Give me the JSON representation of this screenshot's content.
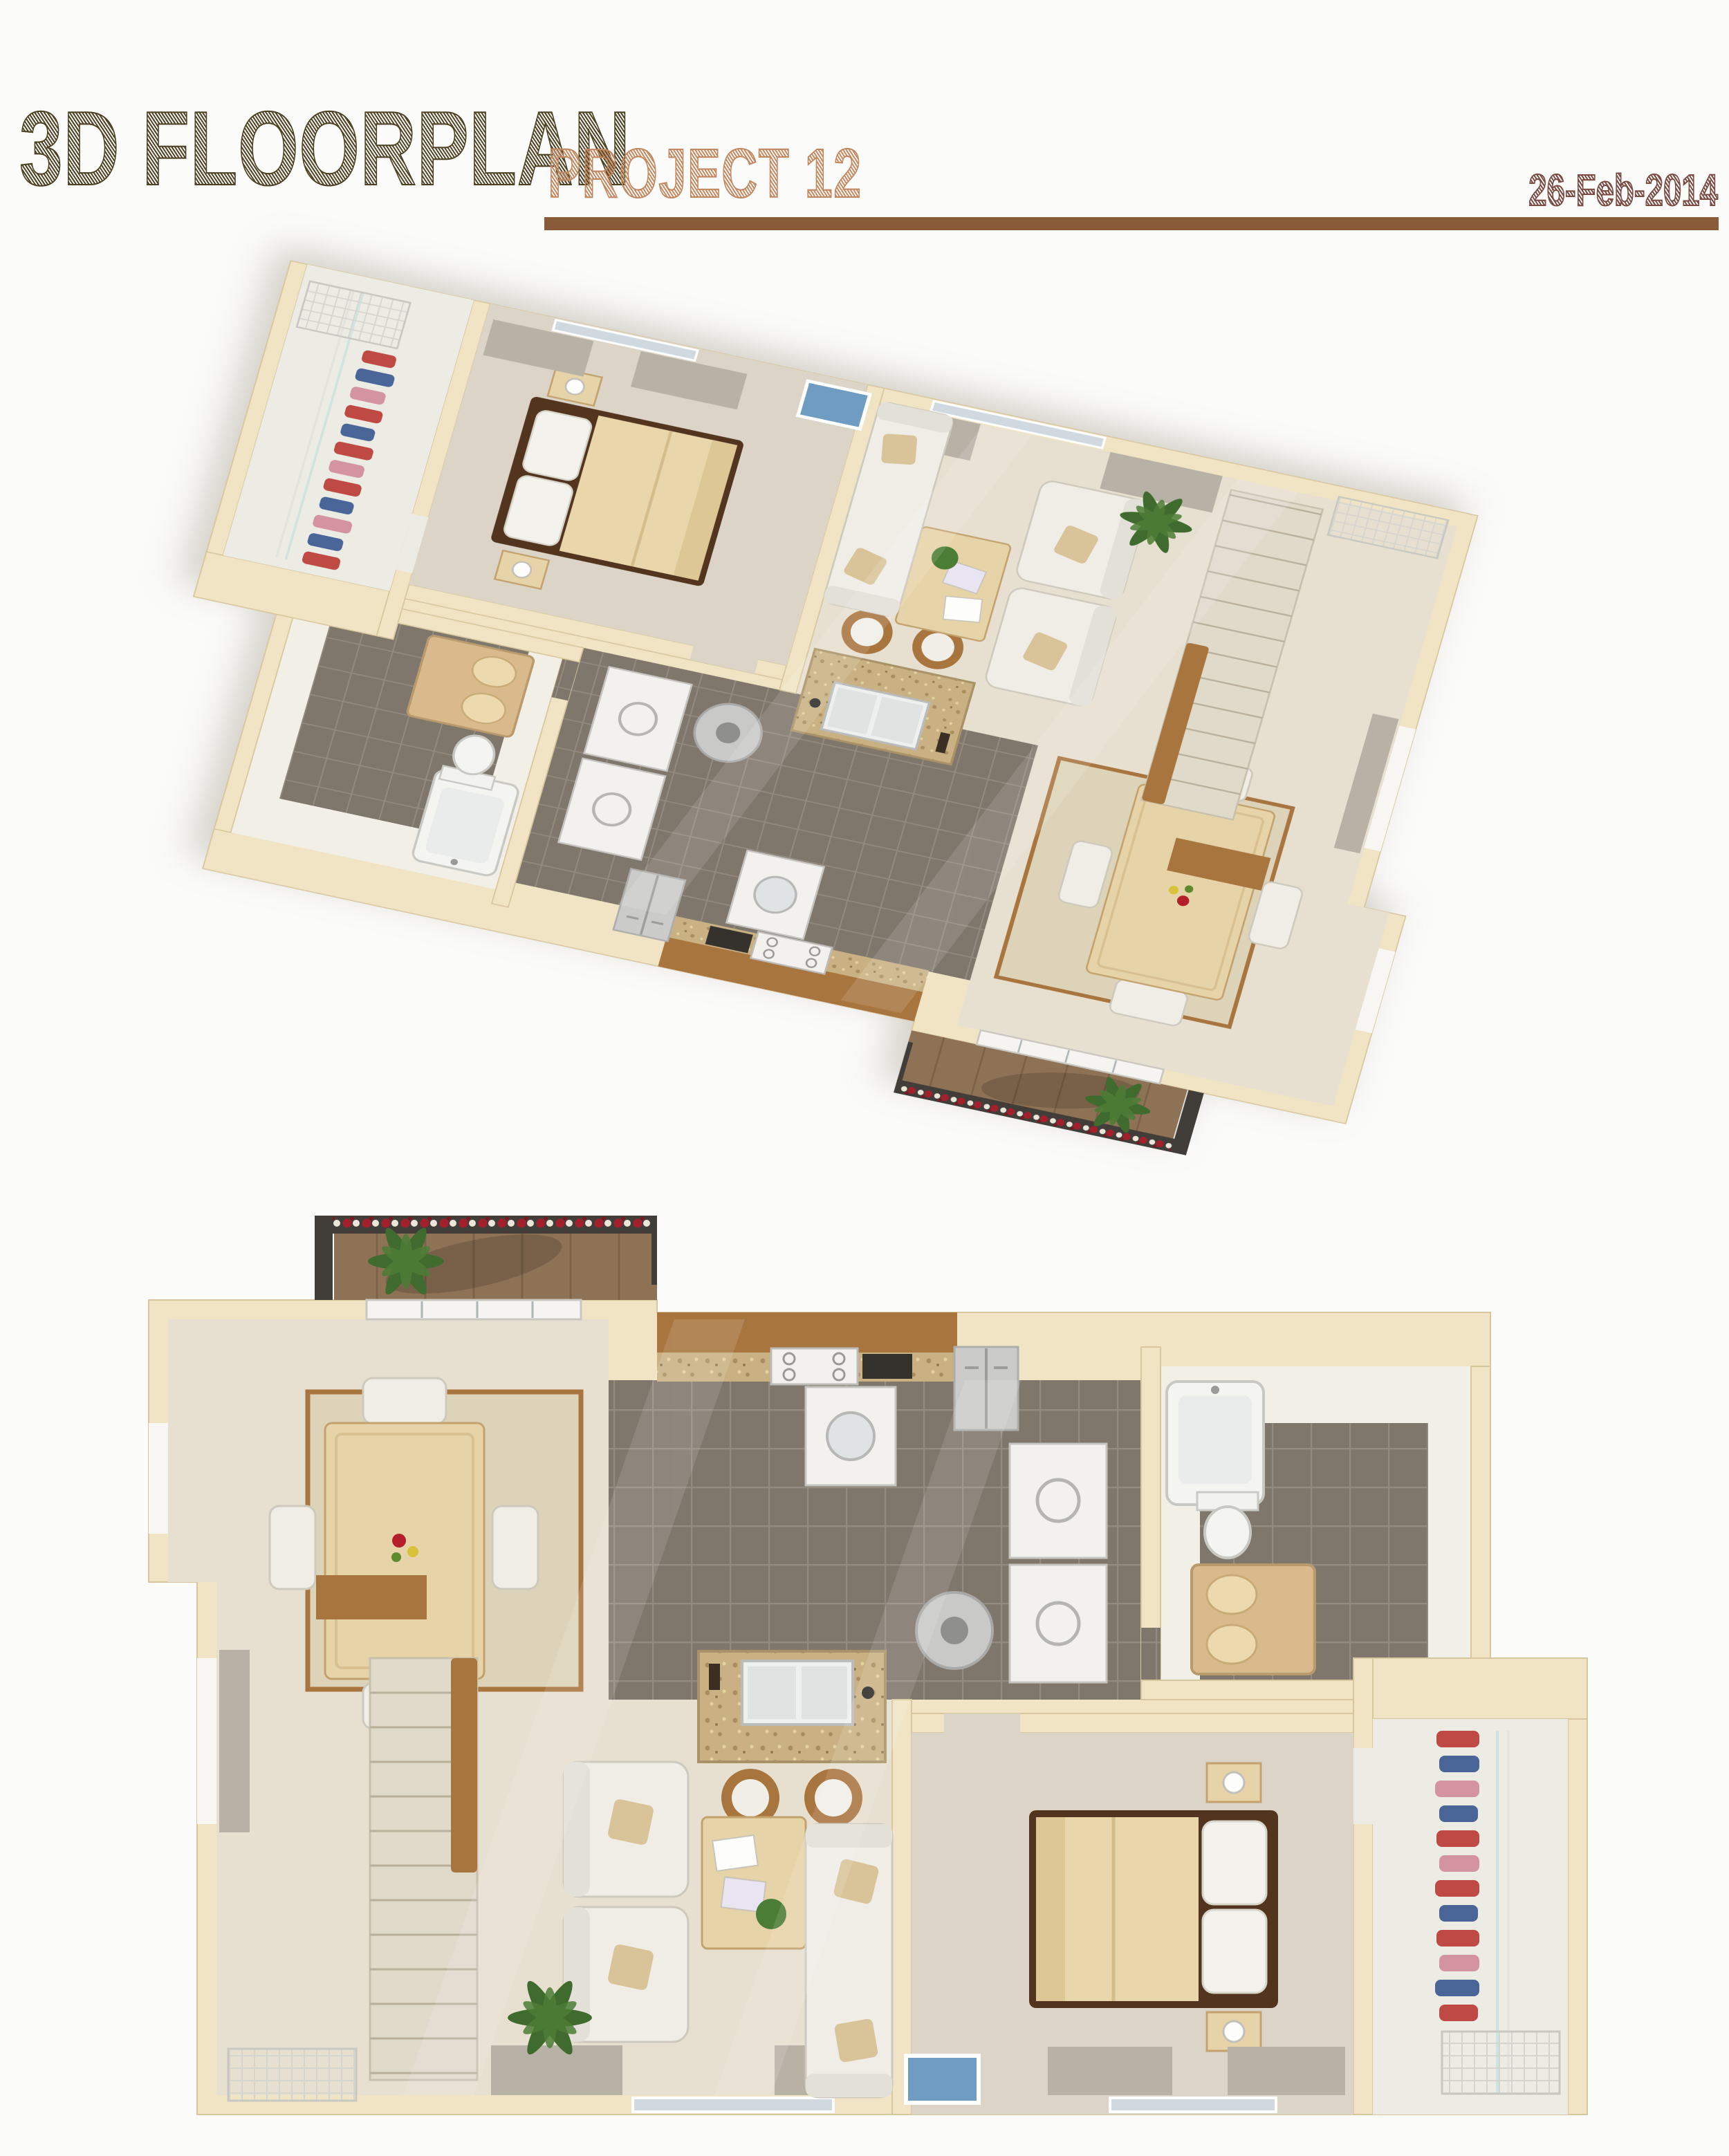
{
  "header": {
    "title": "3D FLOORPLAN",
    "subtitle": "PROJECT 12",
    "date": "26-Feb-2014"
  },
  "colors": {
    "page_background": "#fbfbfa",
    "title": "#4c4122",
    "subtitle": "#c2875e",
    "date": "#7b4a42",
    "rule": "#8a5b38",
    "wall": "#f0e4c4",
    "wall_edge": "#d8c69e",
    "carpet": "#e7e0d0",
    "dining_rug": "#ddd3b8",
    "bedroom_carpet": "#dcd5c7",
    "tile": "#7f766c",
    "tile_grout": "#938a80",
    "wood": "#a9753f",
    "granite": "#c9b183",
    "upholstery": "#f0ede6",
    "bedding": "#e9d7ab",
    "bed_frame": "#53341f",
    "balcony_floor": "#8d7256",
    "railing": "#413e39",
    "flower_red": "#a21f2c",
    "clothes_red": "#bf4a44",
    "clothes_blue": "#4a6699",
    "clothes_pink": "#d393a0",
    "plant_green": "#3f6b2e",
    "glass": "#cfd9df",
    "curtain": "#b8b1a6"
  }
}
